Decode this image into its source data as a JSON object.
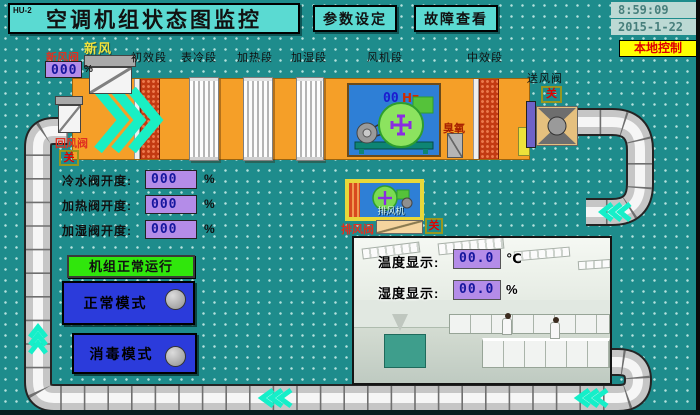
{
  "header": {
    "unit_id": "HU-2",
    "title": "空调机组状态图监控",
    "btn_params": "参数设定",
    "btn_fault": "故障查看",
    "time": "8:59:09",
    "date": "2015-1-22",
    "control_mode": "本地控制"
  },
  "ahu": {
    "fresh_air_label": "新风",
    "fresh_air_valve_label": "新风阀",
    "fresh_air_valve_value": "000",
    "fresh_air_valve_unit": "%",
    "sections": [
      "初效段",
      "表冷段",
      "加热段",
      "加湿段",
      "风机段",
      "中效段"
    ],
    "fan_freq_value": "00",
    "fan_freq_unit": "Hz",
    "ozone_label": "臭氧",
    "supply_valve_label": "送风阀",
    "supply_valve_state": "关",
    "return_valve_label": "回风阀",
    "return_valve_state": "关"
  },
  "readings": {
    "rows": [
      {
        "label": "冷水阀开度:",
        "value": "000",
        "unit": "%"
      },
      {
        "label": "加热阀开度:",
        "value": "000",
        "unit": "%"
      },
      {
        "label": "加湿阀开度:",
        "value": "000",
        "unit": "%"
      }
    ]
  },
  "status": {
    "running_text": "机组正常运行"
  },
  "modes": [
    {
      "label": "正常模式"
    },
    {
      "label": "消毒模式"
    }
  ],
  "exhaust": {
    "fan_label": "排风机",
    "valve_label": "排风阀",
    "valve_state": "关"
  },
  "room": {
    "temp_label": "温度显示:",
    "temp_value": "00.0",
    "temp_unit": "℃",
    "hum_label": "湿度显示:",
    "hum_value": "00.0",
    "hum_unit": "%"
  },
  "colors": {
    "background": "#1E8C8C",
    "panel_cyan": "#5ADAD2",
    "ahu_orange": "#F59F28",
    "flow_cyan": "#15EFC9",
    "value_purple": "#B48CE8",
    "value_text": "#16169E",
    "status_green": "#30E60C",
    "mode_blue": "#2B3BDB",
    "local_bg": "#FFFF00",
    "local_text": "#E00000",
    "fan_panel_blue": "#2E7FD6"
  }
}
